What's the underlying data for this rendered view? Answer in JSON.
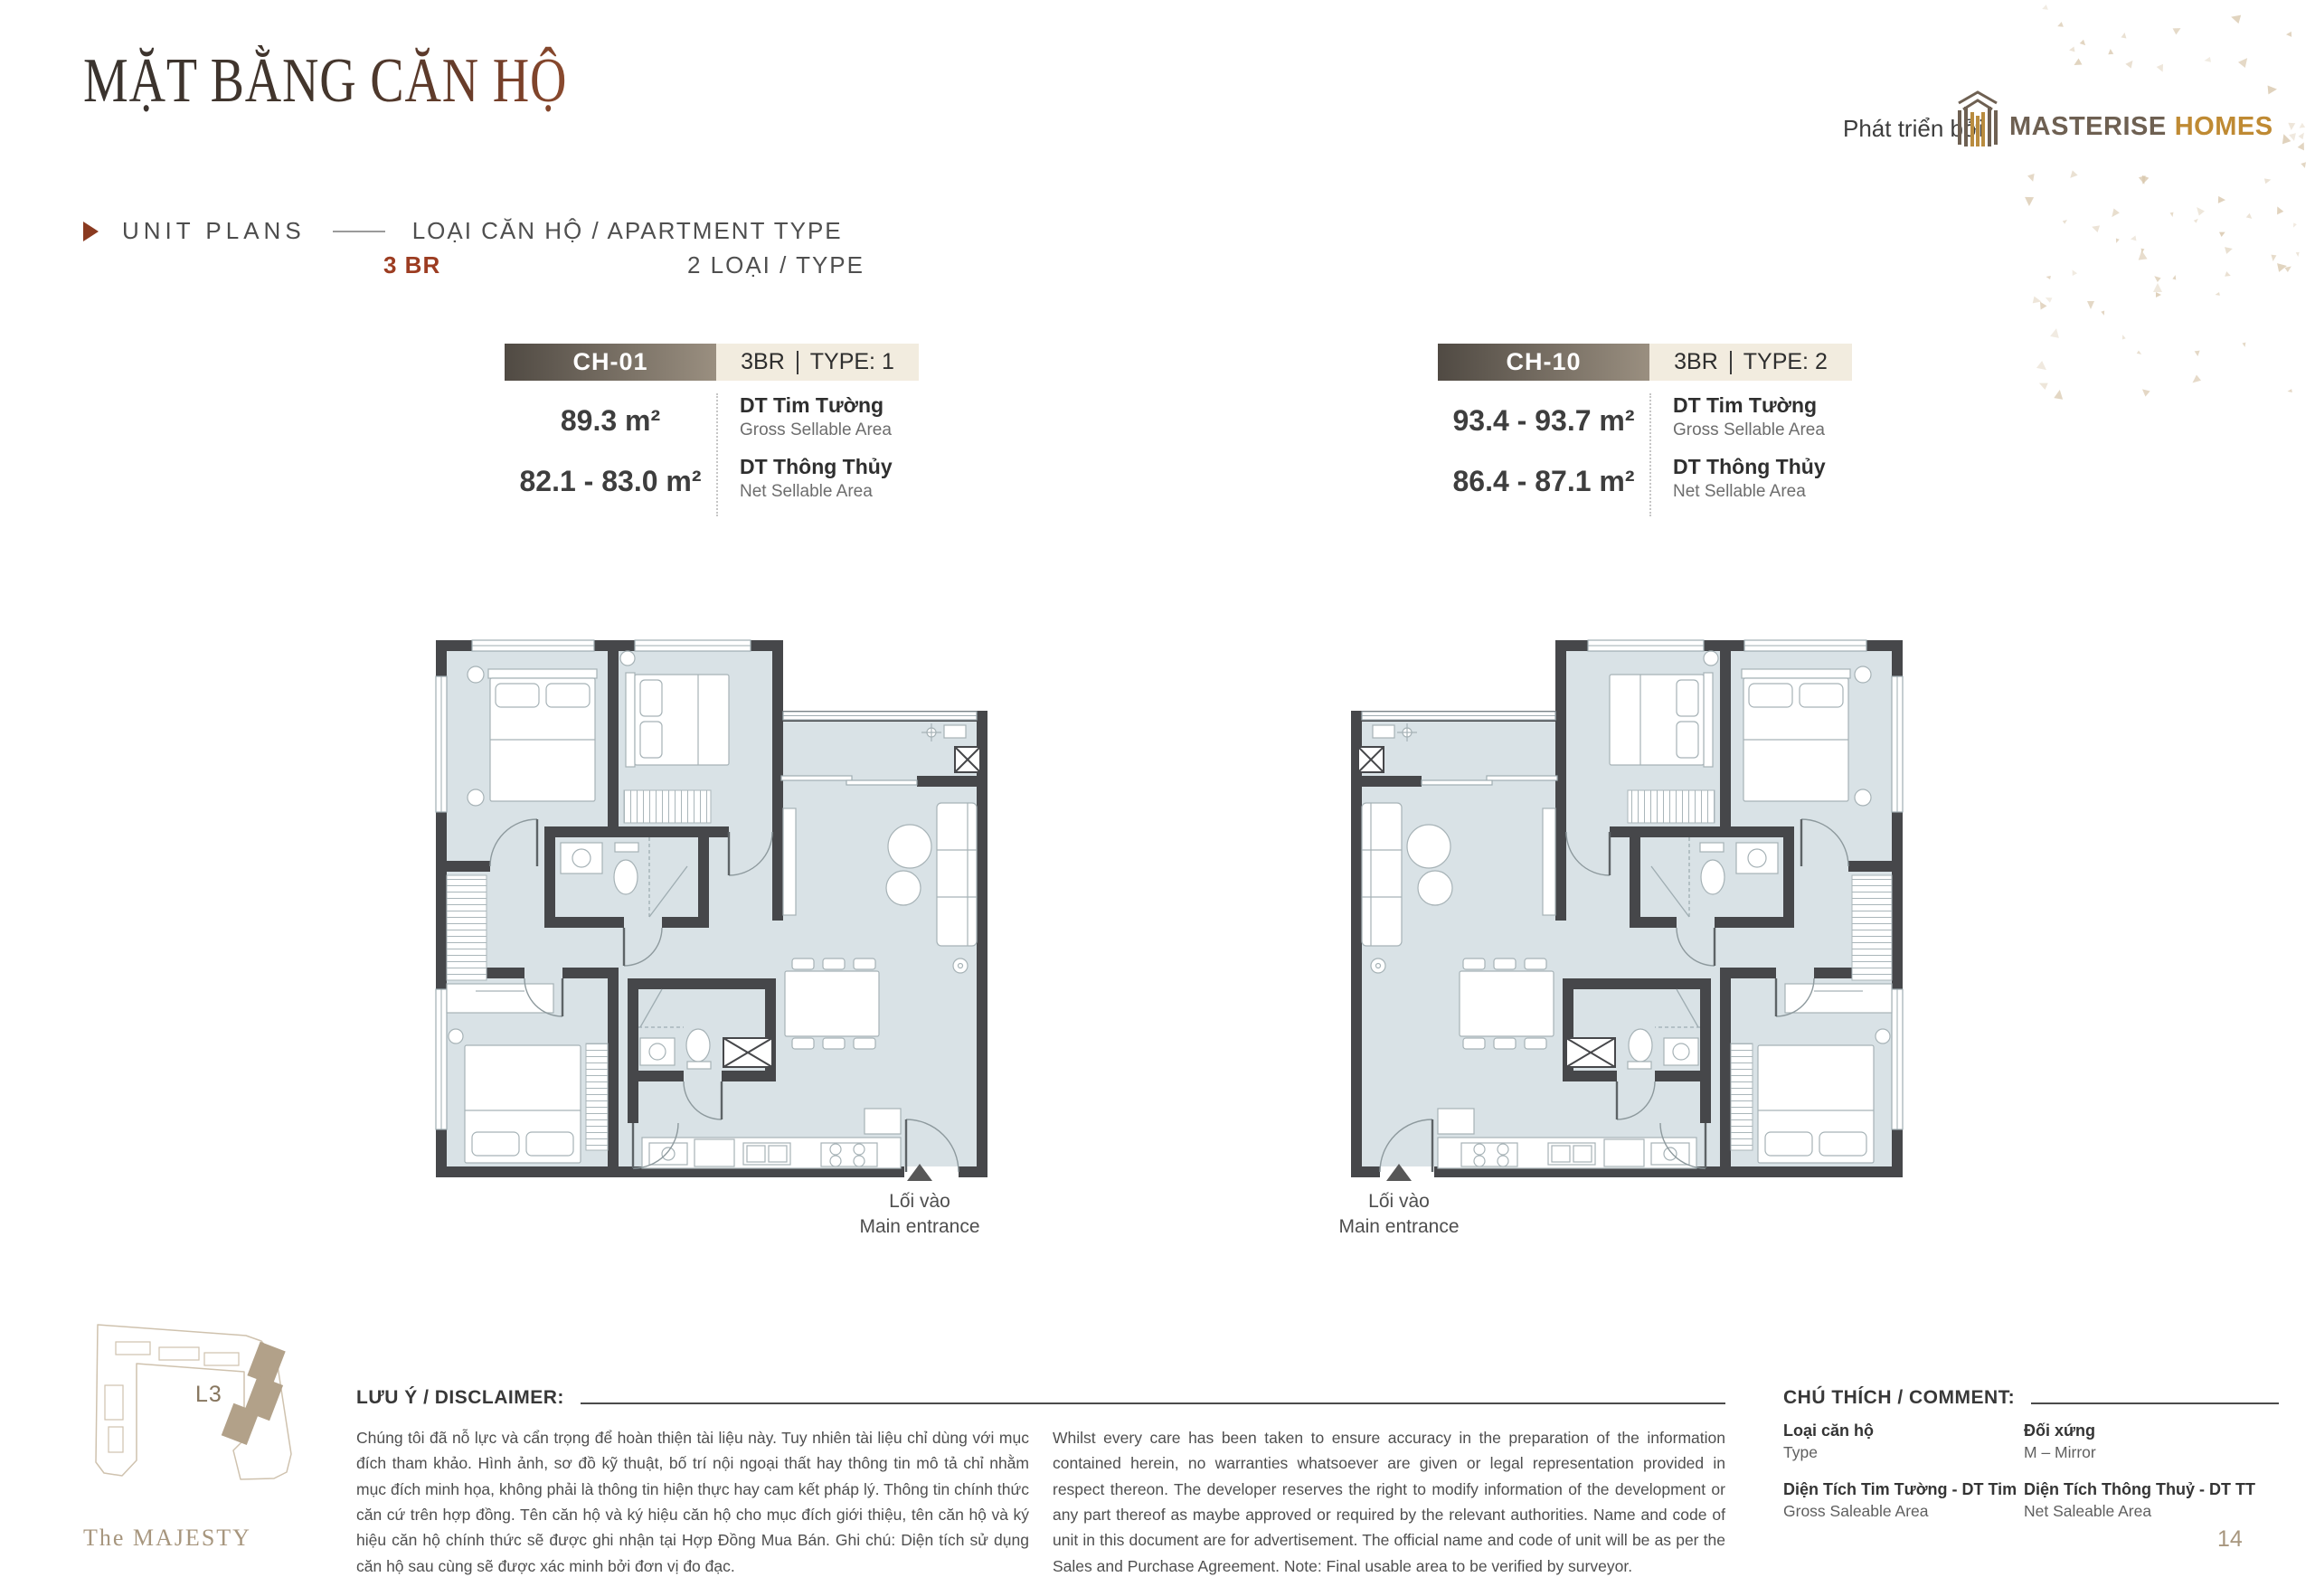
{
  "header": {
    "title": "MẶT BẰNG CĂN HỘ",
    "section_label": "UNIT PLANS",
    "type_heading": "LOẠI CĂN HỘ / APARTMENT TYPE",
    "bedroom_count": "3 BR",
    "type_count": "2 LOẠI / TYPE",
    "developer_prefix": "Phát triển bởi",
    "brand_primary": "MASTERISE",
    "brand_secondary": "HOMES"
  },
  "units": [
    {
      "code": "CH-01",
      "type_br": "3BR",
      "type_no": "TYPE: 1",
      "gross_area": "89.3 m²",
      "net_area": "82.1 - 83.0 m²",
      "gross_label": "DT Tim Tường",
      "gross_sub": "Gross Sellable Area",
      "net_label": "DT Thông Thủy",
      "net_sub": "Net Sellable Area",
      "entrance_vi": "Lối vào",
      "entrance_en": "Main entrance"
    },
    {
      "code": "CH-10",
      "type_br": "3BR",
      "type_no": "TYPE: 2",
      "gross_area": "93.4 - 93.7 m²",
      "net_area": "86.4 - 87.1 m²",
      "gross_label": "DT Tim Tường",
      "gross_sub": "Gross Sellable Area",
      "net_label": "DT Thông Thủy",
      "net_sub": "Net Sellable Area",
      "entrance_vi": "Lối vào",
      "entrance_en": "Main entrance"
    }
  ],
  "site": {
    "level_label": "L3"
  },
  "disclaimer": {
    "heading": "LƯU Ý / DISCLAIMER:",
    "text_vi": "Chúng tôi đã nỗ lực và cẩn trọng để hoàn thiện tài liệu này. Tuy nhiên tài liệu chỉ dùng với mục đích tham khảo. Hình ảnh, sơ đồ kỹ thuật, bố trí nội ngoại thất hay thông tin mô tả chỉ nhằm mục đích minh họa, không phải là thông tin hiện thực hay cam kết pháp lý. Thông tin chính thức căn cứ trên hợp đồng. Tên căn hộ và ký hiệu căn hộ cho mục đích giới thiệu, tên căn hộ và ký hiệu căn hộ chính thức sẽ được ghi nhận tại Hợp Đồng Mua Bán. Ghi chú: Diện tích sử dụng căn hộ sau cùng sẽ được xác minh bởi đơn vị đo đạc.",
    "text_en": "Whilst every care has been taken to ensure accuracy in the preparation of the information contained herein, no warranties whatsoever are given or legal representation provided in respect thereon. The developer reserves the right to modify information of the development or any part thereof as maybe approved or required by the relevant authorities. Name and code of unit in this document are for advertisement. The official name and code of unit will be as per the Sales and Purchase Agreement. Note: Final usable area to be verified by surveyor."
  },
  "legend": {
    "heading": "CHÚ THÍCH / COMMENT:",
    "items": [
      {
        "term": "Loại căn hộ",
        "definition": "Type"
      },
      {
        "term": "Đối xứng",
        "definition": "M – Mirror"
      },
      {
        "term": "Diện Tích Tim Tường - DT Tim",
        "definition": "Gross Saleable Area"
      },
      {
        "term": "Diện Tích Thông Thuỷ - DT TT",
        "definition": "Net Saleable Area"
      }
    ]
  },
  "footer": {
    "project": "The MAJESTY",
    "page": "14"
  },
  "colors": {
    "accent_red": "#9c3c21",
    "brand_brown": "#6e6052",
    "brand_gold": "#bf8a33",
    "bar_dark": "#504a43",
    "bar_light": "#9a8f80",
    "cream": "#f2ecdf",
    "floor": "#d9e2e6",
    "wall": "#46474a",
    "tan": "#a7967e",
    "triangle_deco": "#d9c8ae"
  }
}
